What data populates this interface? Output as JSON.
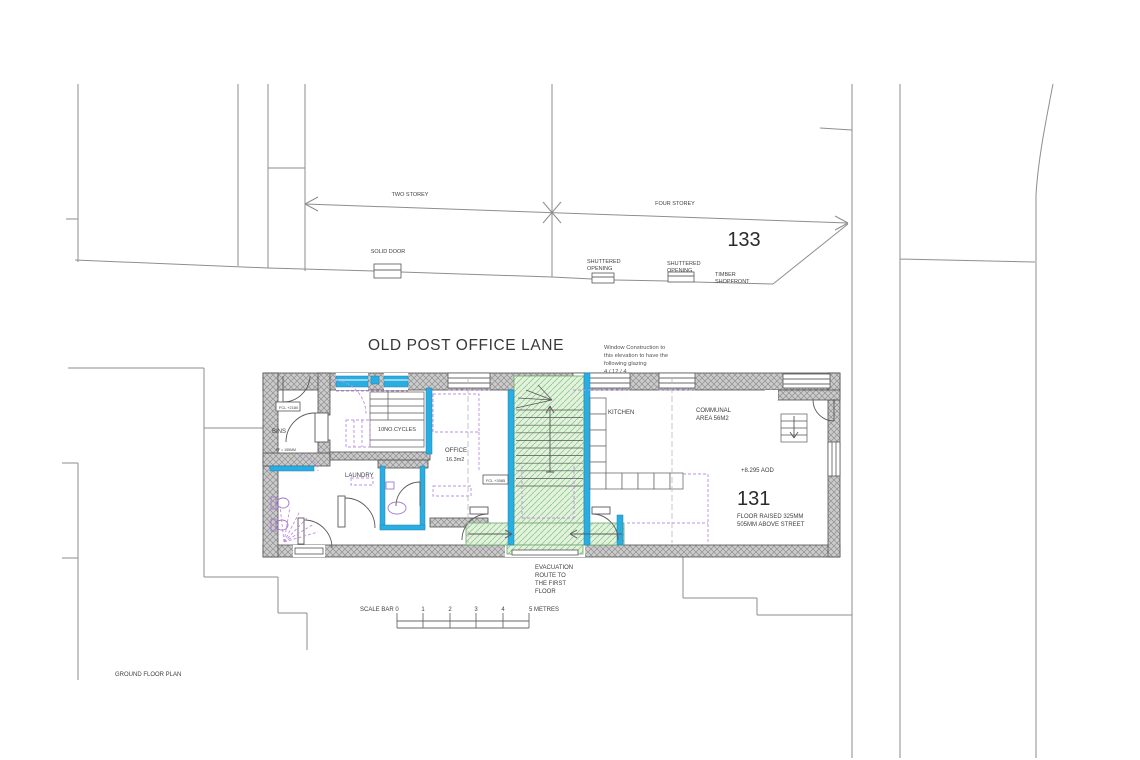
{
  "colors": {
    "accent_cyan": "#2aaee2",
    "evac_green_fill": "#e3f2dd",
    "evac_green_line": "#93cb93",
    "wall_gray": "#cbcbcb",
    "furniture_purple": "#bd8fe0"
  },
  "header": {
    "street_name": "OLD POST OFFICE LANE"
  },
  "site": {
    "two_storey": "TWO STOREY",
    "four_storey": "FOUR STOREY",
    "building_number": "133",
    "solid_door": "SOLID DOOR",
    "shuttered_opening_1": [
      "SHUTTERED",
      "OPENING"
    ],
    "shuttered_opening_2": [
      "SHUTTERED",
      "OPENING"
    ],
    "timber_shopfront": [
      "TIMBER",
      "SHOPFRONT"
    ]
  },
  "notes": {
    "window_glazing": [
      "Window Construction to",
      "this elevation to have the",
      "following glazing",
      "4 / 12 / 4"
    ],
    "evacuation": [
      "EVACUATION",
      "ROUTE TO",
      "THE FIRST",
      "FLOOR"
    ],
    "aod": "+8.295 AOD",
    "unit_number": "131",
    "floor_raised": [
      "FLOOR RAISED 325MM",
      "505MM ABOVE STREET"
    ]
  },
  "rooms": {
    "bins": "BINS",
    "bins_fcl": "FCL +2180",
    "bins_ff": "FF = 155MM",
    "cycles": "10NO.CYCLES",
    "laundry": "LAUNDRY",
    "office": "OFFICE",
    "office_area": "16.3m2",
    "stair_fcl": "FCL +3085",
    "kitchen": "KITCHEN",
    "communal": [
      "COMMUNAL",
      "AREA 56M2"
    ]
  },
  "scale_bar": {
    "label": "SCALE BAR",
    "ticks": [
      "0",
      "1",
      "2",
      "3",
      "4"
    ],
    "end_label": "5 METRES"
  },
  "footer": {
    "drawing_title": "GROUND FLOOR PLAN"
  }
}
